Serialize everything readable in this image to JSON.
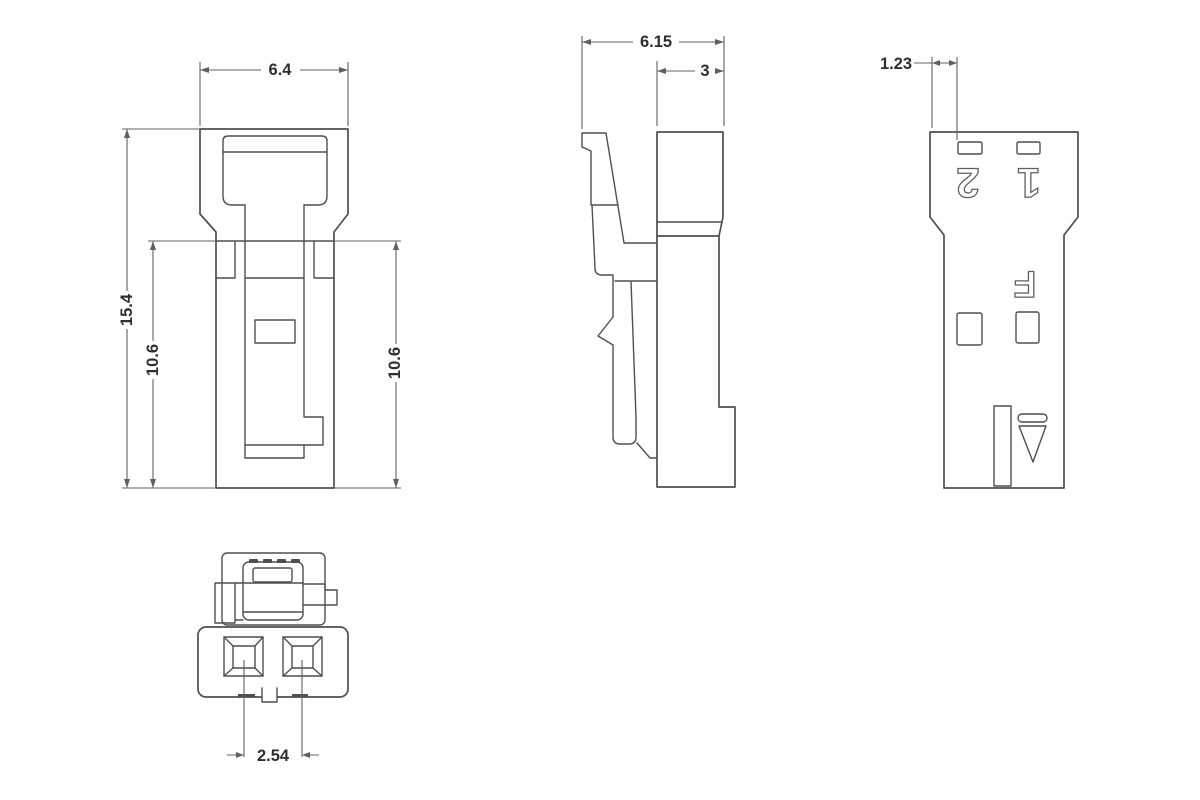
{
  "views": {
    "front": {
      "dim_width": "6.4",
      "dim_height": "15.4",
      "dim_inner_left": "10.6",
      "dim_inner_right": "10.6"
    },
    "side": {
      "dim_depth": "6.15",
      "dim_upper_depth": "3"
    },
    "rear": {
      "dim_cavity_offset": "1.23",
      "label_position_2": "2",
      "label_position_1": "1",
      "label_mark": "F"
    },
    "bottom": {
      "dim_pitch": "2.54"
    }
  },
  "colors": {
    "background": "#ffffff",
    "line": "#4f4f4f",
    "dim_line": "#606060",
    "text": "#2f2f2f",
    "engraving": "#5f5f5f"
  }
}
